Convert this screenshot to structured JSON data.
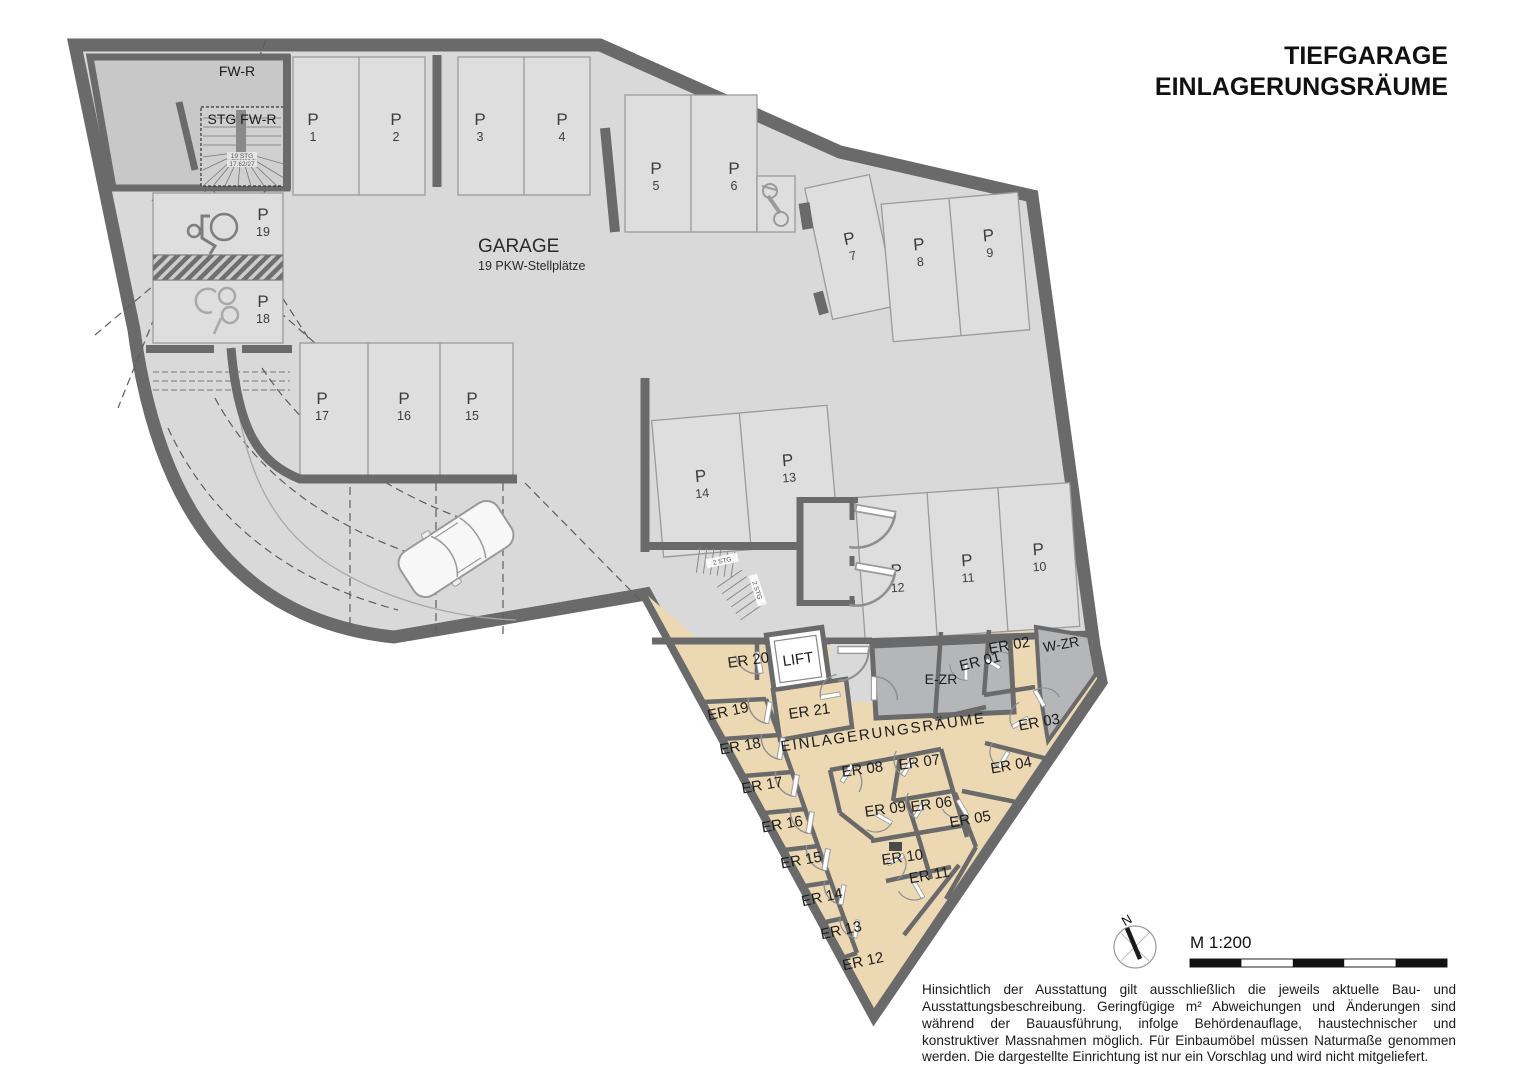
{
  "header": {
    "title_line1": "TIEFGARAGE",
    "title_line2": "EINLAGERUNGSRÄUME"
  },
  "garage": {
    "title": "GARAGE",
    "subtitle": "19 PKW-Stellplätze"
  },
  "area_label": "EINLAGERUNGSRÄUME",
  "parking": [
    {
      "letter": "P",
      "num": "1"
    },
    {
      "letter": "P",
      "num": "2"
    },
    {
      "letter": "P",
      "num": "3"
    },
    {
      "letter": "P",
      "num": "4"
    },
    {
      "letter": "P",
      "num": "5"
    },
    {
      "letter": "P",
      "num": "6"
    },
    {
      "letter": "P",
      "num": "7"
    },
    {
      "letter": "P",
      "num": "8"
    },
    {
      "letter": "P",
      "num": "9"
    },
    {
      "letter": "P",
      "num": "10"
    },
    {
      "letter": "P",
      "num": "11"
    },
    {
      "letter": "P",
      "num": "12"
    },
    {
      "letter": "P",
      "num": "13"
    },
    {
      "letter": "P",
      "num": "14"
    },
    {
      "letter": "P",
      "num": "15"
    },
    {
      "letter": "P",
      "num": "16"
    },
    {
      "letter": "P",
      "num": "17"
    },
    {
      "letter": "P",
      "num": "18"
    },
    {
      "letter": "P",
      "num": "19"
    }
  ],
  "er_labels": [
    "ER 01",
    "ER 02",
    "ER 03",
    "ER 04",
    "ER 05",
    "ER 06",
    "ER 07",
    "ER 08",
    "ER 09",
    "ER 10",
    "ER 11",
    "ER 12",
    "ER 13",
    "ER 14",
    "ER 15",
    "ER 16",
    "ER 17",
    "ER 18",
    "ER 19",
    "ER 20",
    "ER 21"
  ],
  "rooms": {
    "lift": "LIFT",
    "ezr": "E-ZR",
    "wzr": "W-ZR",
    "fwr": "FW-R",
    "stg_fwr": "STG FW-R"
  },
  "stairs": {
    "run_label": "2 STG",
    "spiral_line1": "19 STG",
    "spiral_line2": "17.62/27"
  },
  "compass": {
    "north": "N"
  },
  "scale": {
    "label": "M 1:200"
  },
  "disclaimer": "Hinsichtlich der Ausstattung gilt ausschließlich die jeweils aktuelle Bau- und Ausstattungsbeschreibung. Geringfügige m² Abweichungen und Änderungen sind während der Bauausführung, infolge Behördenauflage, haustechnischer und konstruktiver Massnahmen möglich. Für Einbaumöbel müssen Naturmaße genommen werden. Die dargestellte Einrichtung ist nur ein Vorschlag und wird nicht mitgeliefert.",
  "colors": {
    "wall": "#6a6a6a",
    "floor": "#d9d9da",
    "parking_fill": "#dedede",
    "storage_beige": "#ecd8b2",
    "service_gray": "#b5b6b8",
    "room_gray": "#c8c8c9"
  }
}
